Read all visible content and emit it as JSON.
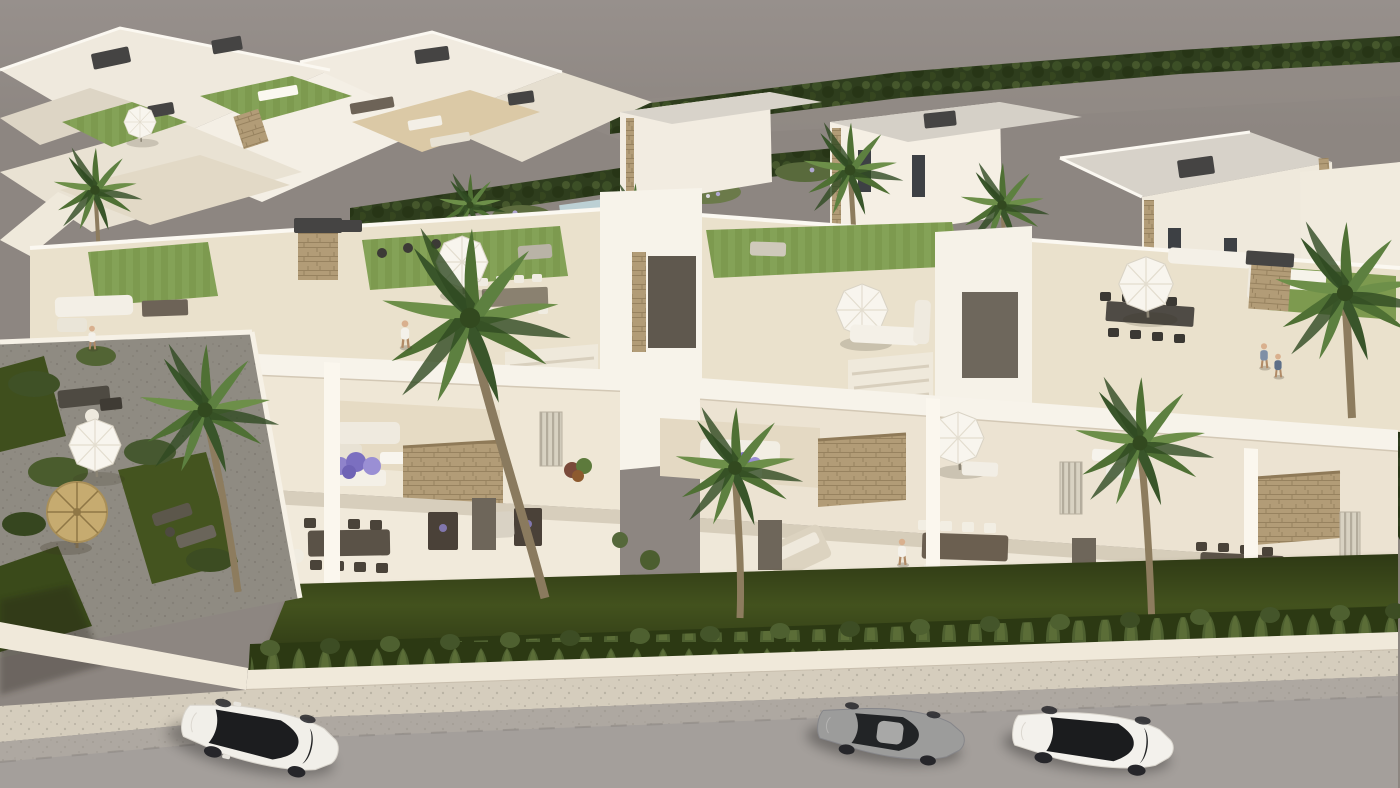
{
  "meta": {
    "description": "Photorealistic 3D aerial rendering of a new-build white residential complex with rooftop terraces, balconies, private gardens, palm trees and a street with three parked cars",
    "view": "high-angle bird's-eye CGI on a warm gray backdrop"
  },
  "palette": {
    "backdrop": "#8d8681",
    "backdrop_top": "#97908c",
    "building_white": "#f7f3ea",
    "building_shade": "#eee6d5",
    "terrace_tile": "#eae1cc",
    "roof_gray": "#d6d1c8",
    "stone_cladding": "#b29c77",
    "dark_fixture": "#454443",
    "roof_lawn": "#7d9a4f",
    "garden_lawn": "#46561f",
    "hedge": "#2c3913",
    "palm_green": "#4f7034",
    "gravel": "#8f8b82",
    "boundary_wall": "#f0e9da",
    "sidewalk": "#d5cdbd",
    "road": "#a49f9b",
    "road_top": "#aea8a1",
    "flower_purple": "#8f83cb",
    "flower_pink": "#c06a8a",
    "glass": "#1c1d1f"
  },
  "scene": {
    "background": {
      "label": "empty warm-gray backdrop above the development"
    },
    "back_left_cluster": {
      "label": "rear apartment block rooftops",
      "features": [
        "roof terraces",
        "green roof lawns",
        "patio umbrella",
        "air-conditioning units",
        "outdoor furniture",
        "stone trims"
      ]
    },
    "back_right_villas": {
      "label": "row of detached white villas",
      "count": 4,
      "features": [
        "flat light-gray roofs",
        "stone-clad corners",
        "dark window slits",
        "dark perimeter hedge on horizon",
        "palm trees"
      ]
    },
    "mid_garden": {
      "label": "communal garden strip between rows",
      "features": [
        "flower beds",
        "hedges",
        "banana plants",
        "small pool",
        "pink bougainvillea"
      ]
    },
    "main_building": {
      "label": "foreground row of two-storey townhouses",
      "units": 4,
      "rooftop": {
        "features": [
          "beige tiled solarium",
          "green lawn patches",
          "white parasols",
          "sun loungers",
          "white outdoor sofas",
          "dining tables",
          "stone chimney blocks with dark caps",
          "stair towers"
        ]
      },
      "middle_floor": {
        "features": [
          "balconies with white sofas",
          "purple flower planters",
          "louvered windows",
          "hanging stone feature panels",
          "balcony parasol"
        ]
      },
      "ground_floor": {
        "features": [
          "terraces with wooden dining sets",
          "double day-bed",
          "dark wood privacy screens",
          "glass doors"
        ]
      }
    },
    "front_garden": {
      "label": "private front lawns",
      "hedge": "continuous row of small conical bushes",
      "wall": "low white boundary wall"
    },
    "left_garden": {
      "label": "corner garden",
      "features": [
        "gravel paths",
        "lawn patches",
        "thatched tiki parasol",
        "white parasol",
        "two sun loungers",
        "dark lounge furniture",
        "shrubs"
      ]
    },
    "street": {
      "label": "gray asphalt road with light sidewalk",
      "lane_marking": "faint dashed edge line"
    },
    "cars": [
      {
        "label": "white SUV with black panoramic roof",
        "body_color": "#f1efe9",
        "position": "left, facing lower-left"
      },
      {
        "label": "gray sports coupe",
        "body_color": "#9c9c9b",
        "position": "center-right, facing left"
      },
      {
        "label": "white sedan with black glass roof",
        "body_color": "#f3f1ec",
        "position": "right, facing left"
      }
    ],
    "people": [
      {
        "label": "person walking on rooftop terrace"
      },
      {
        "label": "two people standing at rooftop railing"
      },
      {
        "label": "person on ground-floor terrace"
      },
      {
        "label": "person in left garden"
      }
    ],
    "parasols": {
      "white_octagonal": 5,
      "thatched_tiki": 1
    },
    "vegetation": {
      "palm_trees": 9,
      "hedge_row_bushes": "≈40 cones",
      "shrubs": "multiple",
      "roof_lawns": 4
    }
  }
}
